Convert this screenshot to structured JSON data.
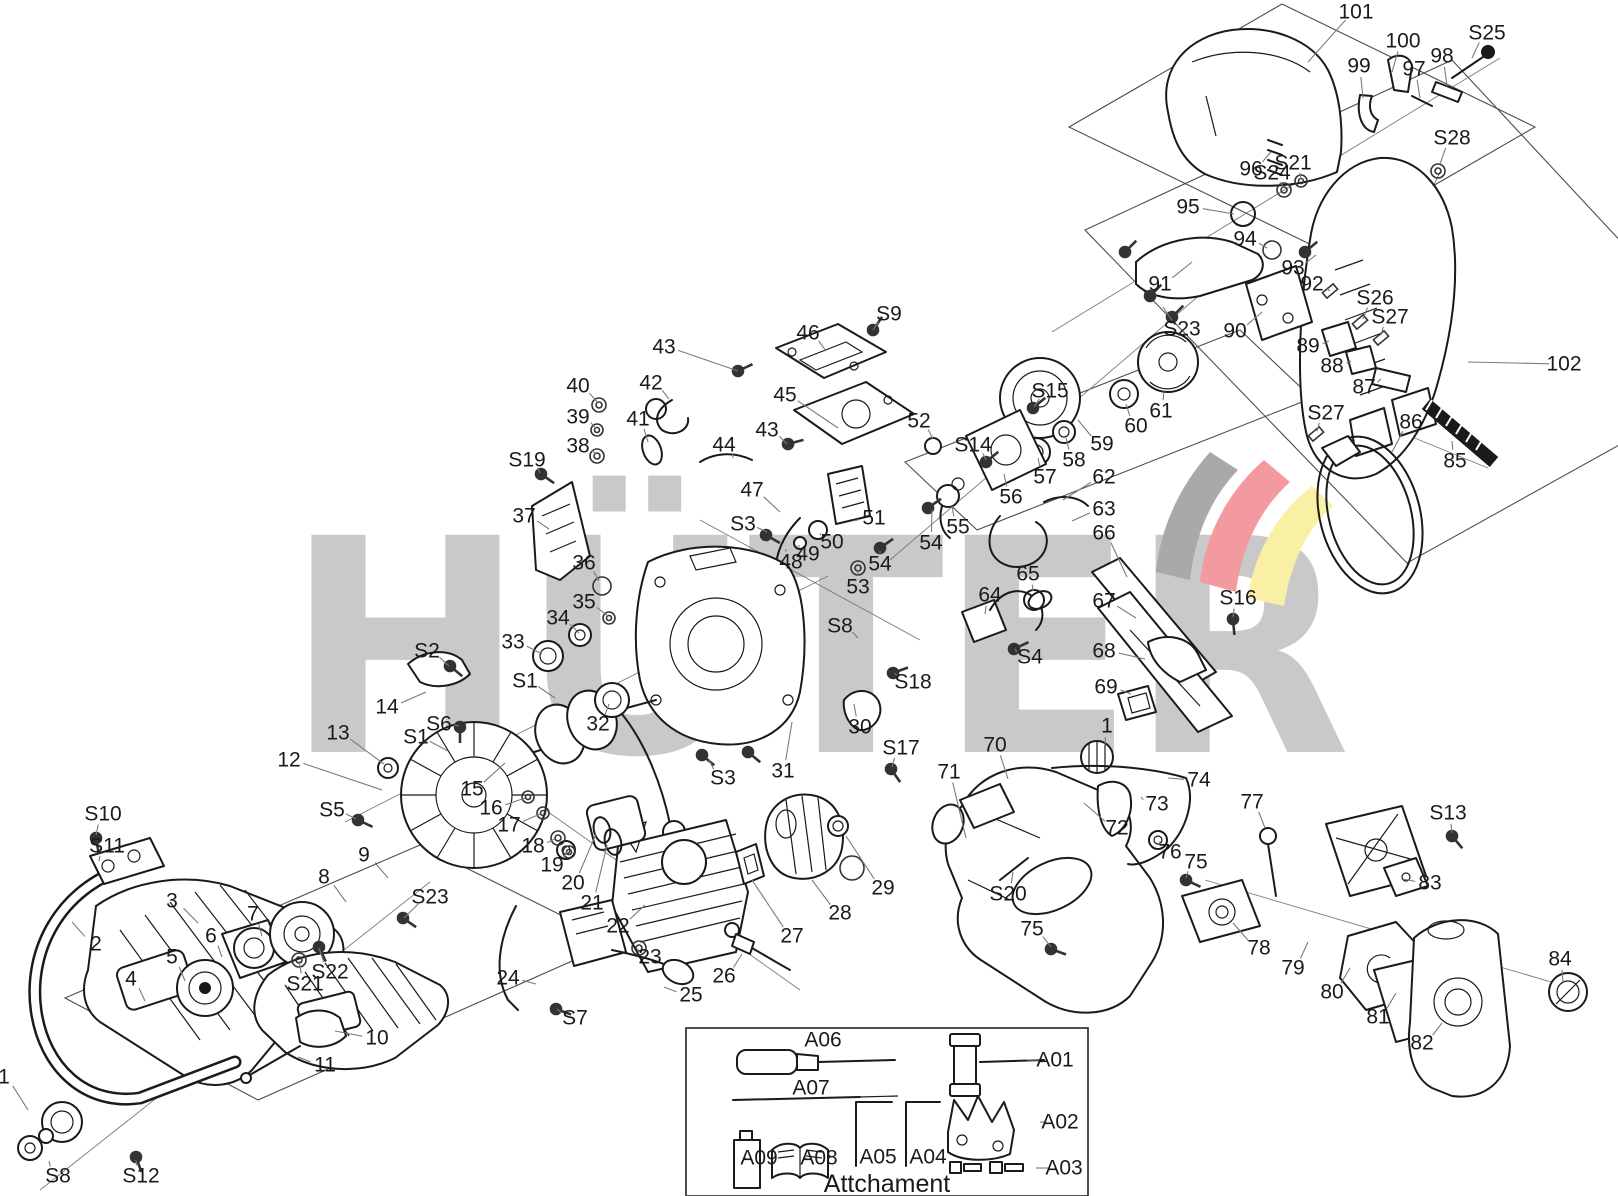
{
  "watermark": {
    "text": "HÜTER",
    "letter_color": "#c9c9c9",
    "swoosh_gray": "#a9a9a9",
    "swoosh_red": "#f29aa0",
    "swoosh_yellow": "#f9f0a6"
  },
  "colors": {
    "line": "#1a1a1a",
    "leader": "#7a7a7a",
    "outline": "#4d4d4d"
  },
  "attachment": {
    "caption": "Attchament"
  },
  "labels": [
    {
      "t": "101",
      "x": 1356,
      "y": 12,
      "l": [
        1308,
        62
      ]
    },
    {
      "t": "100",
      "x": 1403,
      "y": 41,
      "l": [
        1392,
        72
      ]
    },
    {
      "t": "99",
      "x": 1359,
      "y": 66,
      "l": [
        1363,
        98
      ]
    },
    {
      "t": "97",
      "x": 1414,
      "y": 69,
      "l": [
        1420,
        98
      ]
    },
    {
      "t": "98",
      "x": 1442,
      "y": 56,
      "l": [
        1447,
        86
      ]
    },
    {
      "t": "S25",
      "x": 1487,
      "y": 33,
      "l": [
        1472,
        58
      ]
    },
    {
      "t": "S28",
      "x": 1452,
      "y": 138,
      "l": [
        1440,
        164
      ]
    },
    {
      "t": "96",
      "x": 1251,
      "y": 169,
      "l": [
        1271,
        152
      ]
    },
    {
      "t": "S24",
      "x": 1272,
      "y": 173,
      "l": [
        1283,
        188
      ]
    },
    {
      "t": "S21",
      "x": 1293,
      "y": 163,
      "l": [
        1301,
        179
      ]
    },
    {
      "t": "95",
      "x": 1188,
      "y": 207,
      "l": [
        1234,
        214
      ]
    },
    {
      "t": "94",
      "x": 1245,
      "y": 239,
      "l": [
        1267,
        248
      ]
    },
    {
      "t": "93",
      "x": 1293,
      "y": 268,
      "l": [
        1316,
        255
      ]
    },
    {
      "t": "92",
      "x": 1312,
      "y": 284,
      "l": [
        1330,
        291
      ]
    },
    {
      "t": "91",
      "x": 1160,
      "y": 284,
      "l": [
        1192,
        262
      ]
    },
    {
      "t": "S23",
      "x": 1182,
      "y": 329,
      "l": [
        1163,
        307
      ]
    },
    {
      "t": "90",
      "x": 1235,
      "y": 331,
      "l": [
        1262,
        312
      ]
    },
    {
      "t": "S26",
      "x": 1375,
      "y": 298,
      "l": [
        1363,
        319
      ]
    },
    {
      "t": "S27",
      "x": 1390,
      "y": 317,
      "l": [
        1381,
        335
      ]
    },
    {
      "t": "89",
      "x": 1308,
      "y": 346,
      "l": [
        1329,
        341
      ]
    },
    {
      "t": "88",
      "x": 1332,
      "y": 366,
      "l": [
        1351,
        361
      ]
    },
    {
      "t": "87",
      "x": 1364,
      "y": 387,
      "l": [
        1381,
        379
      ]
    },
    {
      "t": "S27",
      "x": 1326,
      "y": 413,
      "l": [
        1317,
        431
      ]
    },
    {
      "t": "86",
      "x": 1411,
      "y": 422,
      "l": [
        1392,
        452
      ]
    },
    {
      "t": "85",
      "x": 1455,
      "y": 461,
      "l": [
        1452,
        441
      ]
    },
    {
      "t": "102",
      "x": 1564,
      "y": 364,
      "l": [
        1468,
        362
      ]
    },
    {
      "t": "S16",
      "x": 1238,
      "y": 598,
      "l": [
        1233,
        617
      ]
    },
    {
      "t": "59",
      "x": 1102,
      "y": 444,
      "l": [
        1078,
        420
      ]
    },
    {
      "t": "60",
      "x": 1136,
      "y": 426,
      "l": [
        1126,
        404
      ]
    },
    {
      "t": "61",
      "x": 1161,
      "y": 411,
      "l": [
        1164,
        390
      ]
    },
    {
      "t": "58",
      "x": 1074,
      "y": 460,
      "l": [
        1066,
        438
      ]
    },
    {
      "t": "57",
      "x": 1045,
      "y": 477,
      "l": [
        1038,
        458
      ]
    },
    {
      "t": "56",
      "x": 1011,
      "y": 497,
      "l": [
        1004,
        474
      ]
    },
    {
      "t": "55",
      "x": 958,
      "y": 527,
      "l": [
        952,
        506
      ]
    },
    {
      "t": "54",
      "x": 931,
      "y": 543,
      "l": [
        932,
        510
      ]
    },
    {
      "t": "54",
      "x": 880,
      "y": 564,
      "l": [
        880,
        551
      ]
    },
    {
      "t": "53",
      "x": 858,
      "y": 587,
      "l": [
        858,
        570
      ]
    },
    {
      "t": "S15",
      "x": 1050,
      "y": 391,
      "l": [
        1034,
        407
      ]
    },
    {
      "t": "S14",
      "x": 973,
      "y": 445,
      "l": [
        986,
        460
      ]
    },
    {
      "t": "52",
      "x": 919,
      "y": 421,
      "l": [
        933,
        439
      ]
    },
    {
      "t": "S9",
      "x": 889,
      "y": 314,
      "l": [
        873,
        330
      ]
    },
    {
      "t": "46",
      "x": 808,
      "y": 333,
      "l": [
        826,
        351
      ]
    },
    {
      "t": "45",
      "x": 785,
      "y": 395,
      "l": [
        838,
        428
      ]
    },
    {
      "t": "43",
      "x": 664,
      "y": 347,
      "l": [
        738,
        371
      ]
    },
    {
      "t": "42",
      "x": 651,
      "y": 383,
      "l": [
        669,
        399
      ]
    },
    {
      "t": "40",
      "x": 578,
      "y": 386,
      "l": [
        598,
        403
      ]
    },
    {
      "t": "39",
      "x": 578,
      "y": 417,
      "l": [
        596,
        428
      ]
    },
    {
      "t": "38",
      "x": 578,
      "y": 446,
      "l": [
        596,
        454
      ]
    },
    {
      "t": "S19",
      "x": 527,
      "y": 460,
      "l": [
        540,
        473
      ]
    },
    {
      "t": "37",
      "x": 524,
      "y": 516,
      "l": [
        549,
        529
      ]
    },
    {
      "t": "41",
      "x": 638,
      "y": 419,
      "l": [
        648,
        442
      ]
    },
    {
      "t": "44",
      "x": 724,
      "y": 445,
      "l": [
        733,
        458
      ]
    },
    {
      "t": "43",
      "x": 767,
      "y": 430,
      "l": [
        787,
        444
      ]
    },
    {
      "t": "47",
      "x": 752,
      "y": 490,
      "l": [
        780,
        512
      ]
    },
    {
      "t": "S3",
      "x": 743,
      "y": 524,
      "l": [
        767,
        532
      ]
    },
    {
      "t": "51",
      "x": 874,
      "y": 518,
      "l": [
        853,
        521
      ]
    },
    {
      "t": "50",
      "x": 832,
      "y": 542,
      "l": [
        821,
        533
      ]
    },
    {
      "t": "49",
      "x": 808,
      "y": 554,
      "l": [
        800,
        546
      ]
    },
    {
      "t": "48",
      "x": 791,
      "y": 562,
      "l": [
        786,
        549
      ]
    },
    {
      "t": "36",
      "x": 584,
      "y": 563,
      "l": [
        599,
        581
      ]
    },
    {
      "t": "35",
      "x": 584,
      "y": 602,
      "l": [
        608,
        616
      ]
    },
    {
      "t": "34",
      "x": 558,
      "y": 618,
      "l": [
        579,
        633
      ]
    },
    {
      "t": "33",
      "x": 513,
      "y": 642,
      "l": [
        542,
        654
      ]
    },
    {
      "t": "S2",
      "x": 427,
      "y": 651,
      "l": [
        449,
        666
      ]
    },
    {
      "t": "S1",
      "x": 525,
      "y": 681,
      "l": [
        555,
        698
      ]
    },
    {
      "t": "32",
      "x": 598,
      "y": 724,
      "l": [
        609,
        704
      ]
    },
    {
      "t": "14",
      "x": 387,
      "y": 707,
      "l": [
        426,
        692
      ]
    },
    {
      "t": "S6",
      "x": 439,
      "y": 724,
      "l": [
        459,
        726
      ]
    },
    {
      "t": "S1",
      "x": 416,
      "y": 737,
      "l": [
        448,
        751
      ]
    },
    {
      "t": "13",
      "x": 338,
      "y": 733,
      "l": [
        384,
        764
      ]
    },
    {
      "t": "12",
      "x": 289,
      "y": 760,
      "l": [
        382,
        790
      ]
    },
    {
      "t": "S5",
      "x": 332,
      "y": 810,
      "l": [
        356,
        819
      ]
    },
    {
      "t": "15",
      "x": 472,
      "y": 789,
      "l": [
        505,
        763
      ]
    },
    {
      "t": "16",
      "x": 491,
      "y": 808,
      "l": [
        525,
        798
      ]
    },
    {
      "t": "17",
      "x": 509,
      "y": 825,
      "l": [
        540,
        814
      ]
    },
    {
      "t": "18",
      "x": 533,
      "y": 846,
      "l": [
        555,
        839
      ]
    },
    {
      "t": "19",
      "x": 552,
      "y": 865,
      "l": [
        567,
        852
      ]
    },
    {
      "t": "20",
      "x": 573,
      "y": 883,
      "l": [
        596,
        834
      ]
    },
    {
      "t": "21",
      "x": 592,
      "y": 903,
      "l": [
        607,
        845
      ]
    },
    {
      "t": "22",
      "x": 618,
      "y": 926,
      "l": [
        645,
        905
      ]
    },
    {
      "t": "23",
      "x": 650,
      "y": 957,
      "l": [
        638,
        949
      ]
    },
    {
      "t": "24",
      "x": 508,
      "y": 978,
      "l": [
        536,
        984
      ]
    },
    {
      "t": "S7",
      "x": 575,
      "y": 1018,
      "l": [
        557,
        1009
      ]
    },
    {
      "t": "25",
      "x": 691,
      "y": 995,
      "l": [
        664,
        987
      ]
    },
    {
      "t": "26",
      "x": 724,
      "y": 976,
      "l": [
        742,
        954
      ]
    },
    {
      "t": "27",
      "x": 792,
      "y": 936,
      "l": [
        752,
        880
      ]
    },
    {
      "t": "28",
      "x": 840,
      "y": 913,
      "l": [
        812,
        880
      ]
    },
    {
      "t": "29",
      "x": 883,
      "y": 888,
      "l": [
        846,
        836
      ]
    },
    {
      "t": "30",
      "x": 860,
      "y": 727,
      "l": [
        854,
        704
      ]
    },
    {
      "t": "S18",
      "x": 913,
      "y": 682,
      "l": [
        894,
        673
      ]
    },
    {
      "t": "S8",
      "x": 840,
      "y": 626,
      "l": [
        858,
        638
      ]
    },
    {
      "t": "31",
      "x": 783,
      "y": 771,
      "l": [
        792,
        722
      ]
    },
    {
      "t": "S3",
      "x": 723,
      "y": 778,
      "l": [
        709,
        760
      ]
    },
    {
      "t": "S17",
      "x": 901,
      "y": 748,
      "l": [
        892,
        767
      ]
    },
    {
      "t": "64",
      "x": 990,
      "y": 595,
      "l": [
        985,
        614
      ]
    },
    {
      "t": "65",
      "x": 1028,
      "y": 574,
      "l": [
        1033,
        591
      ]
    },
    {
      "t": "S4",
      "x": 1030,
      "y": 657,
      "l": [
        1015,
        649
      ]
    },
    {
      "t": "62",
      "x": 1104,
      "y": 477,
      "l": [
        1063,
        500
      ]
    },
    {
      "t": "63",
      "x": 1104,
      "y": 509,
      "l": [
        1072,
        521
      ]
    },
    {
      "t": "66",
      "x": 1104,
      "y": 533,
      "l": [
        1127,
        577
      ]
    },
    {
      "t": "67",
      "x": 1104,
      "y": 601,
      "l": [
        1136,
        618
      ]
    },
    {
      "t": "68",
      "x": 1104,
      "y": 651,
      "l": [
        1145,
        659
      ]
    },
    {
      "t": "69",
      "x": 1106,
      "y": 687,
      "l": [
        1131,
        694
      ]
    },
    {
      "t": "1",
      "x": 1107,
      "y": 726,
      "l": [
        1105,
        745
      ]
    },
    {
      "t": "70",
      "x": 995,
      "y": 745,
      "l": [
        1008,
        779
      ]
    },
    {
      "t": "71",
      "x": 949,
      "y": 772,
      "l": [
        966,
        838
      ]
    },
    {
      "t": "74",
      "x": 1199,
      "y": 780,
      "l": [
        1168,
        778
      ]
    },
    {
      "t": "73",
      "x": 1157,
      "y": 804,
      "l": [
        1141,
        797
      ]
    },
    {
      "t": "72",
      "x": 1117,
      "y": 828,
      "l": [
        1084,
        803
      ]
    },
    {
      "t": "77",
      "x": 1252,
      "y": 802,
      "l": [
        1265,
        828
      ]
    },
    {
      "t": "76",
      "x": 1170,
      "y": 852,
      "l": [
        1160,
        841
      ]
    },
    {
      "t": "75",
      "x": 1196,
      "y": 862,
      "l": [
        1186,
        878
      ]
    },
    {
      "t": "S20",
      "x": 1008,
      "y": 894,
      "l": [
        1013,
        872
      ]
    },
    {
      "t": "75",
      "x": 1032,
      "y": 929,
      "l": [
        1051,
        947
      ]
    },
    {
      "t": "78",
      "x": 1259,
      "y": 948,
      "l": [
        1233,
        923
      ]
    },
    {
      "t": "79",
      "x": 1293,
      "y": 968,
      "l": [
        1308,
        942
      ]
    },
    {
      "t": "80",
      "x": 1332,
      "y": 992,
      "l": [
        1350,
        968
      ]
    },
    {
      "t": "81",
      "x": 1378,
      "y": 1017,
      "l": [
        1396,
        993
      ]
    },
    {
      "t": "82",
      "x": 1422,
      "y": 1043,
      "l": [
        1442,
        1023
      ]
    },
    {
      "t": "83",
      "x": 1430,
      "y": 883,
      "l": [
        1403,
        879
      ]
    },
    {
      "t": "84",
      "x": 1560,
      "y": 959,
      "l": [
        1563,
        982
      ]
    },
    {
      "t": "S13",
      "x": 1448,
      "y": 813,
      "l": [
        1452,
        833
      ]
    },
    {
      "t": "S10",
      "x": 103,
      "y": 814,
      "l": [
        96,
        835
      ]
    },
    {
      "t": "S11",
      "x": 107,
      "y": 846,
      "l": [
        99,
        861
      ]
    },
    {
      "t": "2",
      "x": 96,
      "y": 944,
      "l": [
        72,
        922
      ]
    },
    {
      "t": "3",
      "x": 172,
      "y": 901,
      "l": [
        198,
        923
      ]
    },
    {
      "t": "7",
      "x": 253,
      "y": 914,
      "l": [
        262,
        936
      ]
    },
    {
      "t": "6",
      "x": 211,
      "y": 936,
      "l": [
        222,
        957
      ]
    },
    {
      "t": "5",
      "x": 172,
      "y": 957,
      "l": [
        185,
        981
      ]
    },
    {
      "t": "4",
      "x": 131,
      "y": 979,
      "l": [
        145,
        1001
      ]
    },
    {
      "t": "8",
      "x": 324,
      "y": 877,
      "l": [
        346,
        902
      ]
    },
    {
      "t": "9",
      "x": 364,
      "y": 855,
      "l": [
        388,
        878
      ]
    },
    {
      "t": "S22",
      "x": 330,
      "y": 972,
      "l": [
        319,
        948
      ]
    },
    {
      "t": "S21",
      "x": 305,
      "y": 984,
      "l": [
        299,
        961
      ]
    },
    {
      "t": "10",
      "x": 377,
      "y": 1038,
      "l": [
        335,
        1031
      ]
    },
    {
      "t": "11",
      "x": 325,
      "y": 1065,
      "l": [
        298,
        1057
      ]
    },
    {
      "t": "S23",
      "x": 430,
      "y": 897,
      "l": [
        404,
        918
      ]
    },
    {
      "t": "1",
      "x": 4,
      "y": 1077,
      "l": [
        28,
        1110
      ]
    },
    {
      "t": "S8",
      "x": 58,
      "y": 1176,
      "l": [
        49,
        1161
      ]
    },
    {
      "t": "S12",
      "x": 141,
      "y": 1176,
      "l": [
        136,
        1160
      ]
    },
    {
      "t": "A06",
      "x": 823,
      "y": 1040
    },
    {
      "t": "A07",
      "x": 811,
      "y": 1088
    },
    {
      "t": "A01",
      "x": 1055,
      "y": 1060,
      "l": [
        1027,
        1060
      ]
    },
    {
      "t": "A02",
      "x": 1060,
      "y": 1122,
      "l": [
        1040,
        1122
      ]
    },
    {
      "t": "A03",
      "x": 1064,
      "y": 1168,
      "l": [
        1036,
        1168
      ]
    },
    {
      "t": "A04",
      "x": 928,
      "y": 1157,
      "l": [
        914,
        1157
      ]
    },
    {
      "t": "A05",
      "x": 878,
      "y": 1157,
      "l": [
        864,
        1157
      ]
    },
    {
      "t": "A08",
      "x": 819,
      "y": 1158,
      "l": [
        806,
        1158
      ]
    },
    {
      "t": "A09",
      "x": 759,
      "y": 1158,
      "l": [
        746,
        1158
      ]
    }
  ]
}
